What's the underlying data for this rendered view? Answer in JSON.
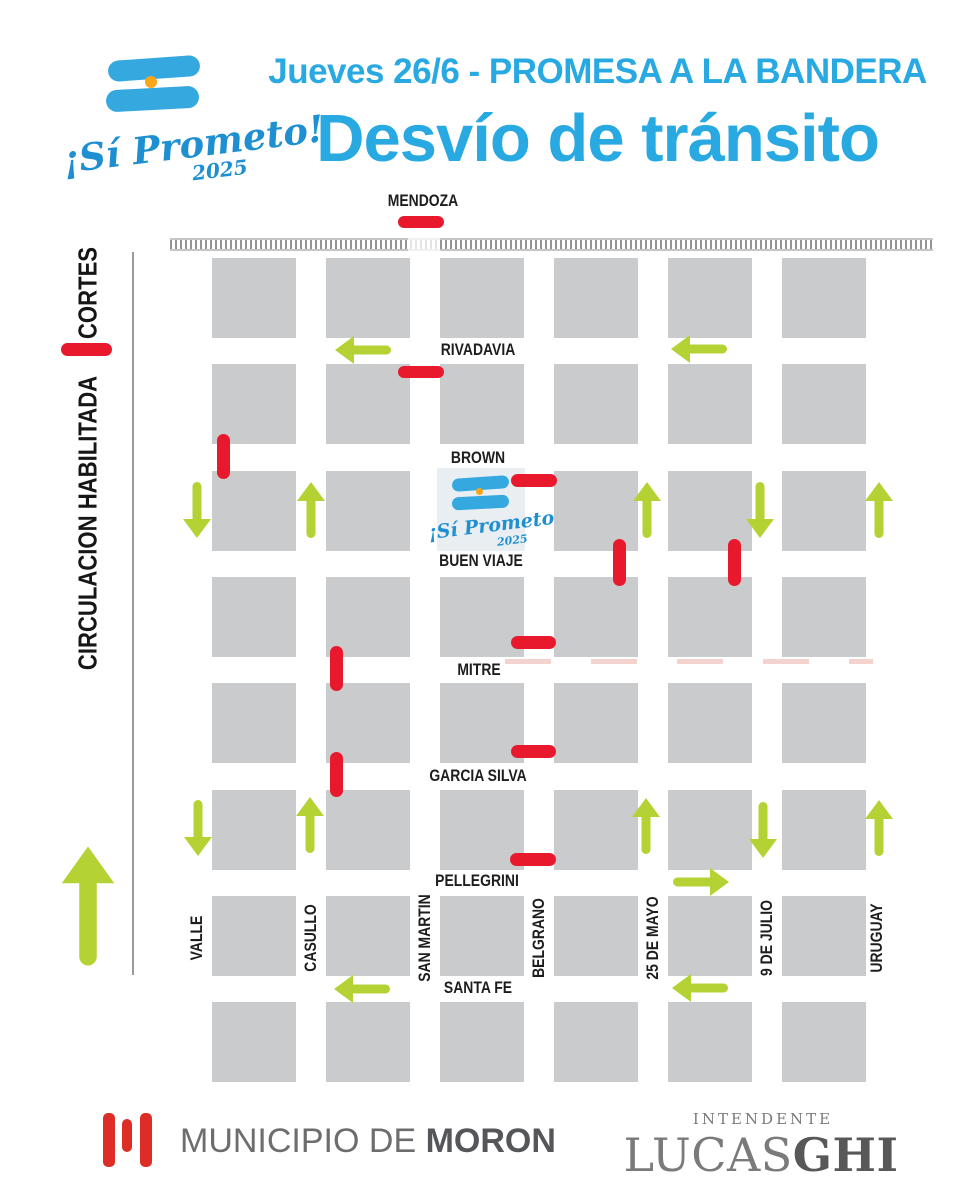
{
  "header": {
    "logo": {
      "script": "¡Sí Prometo!",
      "year": "2025"
    },
    "date_line": "Jueves 26/6 - PROMESA A LA BANDERA",
    "title": "Desvío de tránsito"
  },
  "legend": {
    "cortes_label": "CORTES",
    "circulacion_label": "CIRCULACION HABILITADA"
  },
  "map": {
    "grid": {
      "col_lefts": [
        212,
        326,
        440,
        554,
        668,
        782
      ],
      "row_tops": [
        258,
        364,
        471,
        577,
        683,
        790,
        896,
        1002
      ],
      "block_w": 84,
      "block_h": 80,
      "logo_block": {
        "col": 2,
        "row": 2
      }
    },
    "railway": {
      "x": 170,
      "y": 238,
      "w": 763,
      "h": 13,
      "gap_x": 408,
      "gap_w": 32
    },
    "edge_line": {
      "x": 132,
      "y": 252,
      "h": 723
    },
    "mitre_dashes": {
      "x": 505,
      "y": 659,
      "w": 368,
      "h": 5
    },
    "streets_horizontal": [
      "MENDOZA",
      "RIVADAVIA",
      "BROWN",
      "BUEN VIAJE",
      "MITRE",
      "GARCIA SILVA",
      "PELLEGRINI",
      "SANTA FE"
    ],
    "streets_vertical": [
      "VALLE",
      "CASULLO",
      "SAN MARTIN",
      "BELGRANO",
      "25 DE MAYO",
      "9 DE JULIO",
      "URUGUAY"
    ],
    "labels_h": [
      {
        "text": "MENDOZA",
        "x": 423,
        "y": 201
      },
      {
        "text": "RIVADAVIA",
        "x": 478,
        "y": 350
      },
      {
        "text": "BROWN",
        "x": 478,
        "y": 458
      },
      {
        "text": "BUEN VIAJE",
        "x": 481,
        "y": 561
      },
      {
        "text": "MITRE",
        "x": 479,
        "y": 670
      },
      {
        "text": "GARCIA SILVA",
        "x": 478,
        "y": 776
      },
      {
        "text": "PELLEGRINI",
        "x": 477,
        "y": 881
      },
      {
        "text": "SANTA FE",
        "x": 478,
        "y": 988
      }
    ],
    "labels_v": [
      {
        "text": "VALLE",
        "x": 197,
        "y": 938
      },
      {
        "text": "CASULLO",
        "x": 311,
        "y": 938
      },
      {
        "text": "SAN MARTIN",
        "x": 425,
        "y": 938
      },
      {
        "text": "BELGRANO",
        "x": 539,
        "y": 938
      },
      {
        "text": "25 DE MAYO",
        "x": 653,
        "y": 938
      },
      {
        "text": "9 DE JULIO",
        "x": 767,
        "y": 938
      },
      {
        "text": "URUGUAY",
        "x": 877,
        "y": 938
      }
    ],
    "closures": [
      {
        "street": "SAN MARTIN",
        "at": "MENDOZA",
        "x": 398,
        "y": 216,
        "w": 46,
        "h": 12
      },
      {
        "street": "SAN MARTIN",
        "at": "RIVADAVIA",
        "x": 398,
        "y": 366,
        "w": 46,
        "h": 12
      },
      {
        "street": "BROWN",
        "at": "VALLE",
        "x": 217,
        "y": 434,
        "w": 13,
        "h": 45
      },
      {
        "street": "BELGRANO",
        "at": "BROWN",
        "x": 511,
        "y": 474,
        "w": 46,
        "h": 13
      },
      {
        "street": "BUEN VIAJE",
        "at": "25 DE MAYO",
        "x": 613,
        "y": 539,
        "w": 13,
        "h": 47
      },
      {
        "street": "BUEN VIAJE",
        "at": "9 DE JULIO",
        "x": 728,
        "y": 539,
        "w": 13,
        "h": 47
      },
      {
        "street": "BELGRANO",
        "at": "MITRE",
        "x": 511,
        "y": 636,
        "w": 45,
        "h": 13
      },
      {
        "street": "MITRE",
        "at": "CASULLO",
        "x": 330,
        "y": 646,
        "w": 13,
        "h": 45
      },
      {
        "street": "BELGRANO",
        "at": "GARCIA SILVA",
        "x": 511,
        "y": 745,
        "w": 45,
        "h": 13
      },
      {
        "street": "GARCIA SILVA",
        "at": "CASULLO",
        "x": 330,
        "y": 752,
        "w": 13,
        "h": 45
      },
      {
        "street": "BELGRANO",
        "at": "PELLEGRINI",
        "x": 510,
        "y": 853,
        "w": 46,
        "h": 13
      }
    ],
    "arrows": [
      {
        "street": "RIVADAVIA",
        "dir": "left",
        "x": 363,
        "y": 350
      },
      {
        "street": "RIVADAVIA",
        "dir": "left",
        "x": 699,
        "y": 349
      },
      {
        "street": "VALLE",
        "dir": "down",
        "x": 197,
        "y": 510
      },
      {
        "street": "CASULLO",
        "dir": "up",
        "x": 311,
        "y": 510
      },
      {
        "street": "25 DE MAYO",
        "dir": "up",
        "x": 647,
        "y": 510
      },
      {
        "street": "9 DE JULIO",
        "dir": "down",
        "x": 760,
        "y": 510
      },
      {
        "street": "URUGUAY",
        "dir": "up",
        "x": 879,
        "y": 510
      },
      {
        "street": "VALLE",
        "dir": "down",
        "x": 198,
        "y": 828
      },
      {
        "street": "CASULLO",
        "dir": "up",
        "x": 310,
        "y": 825
      },
      {
        "street": "25 DE MAYO",
        "dir": "up",
        "x": 646,
        "y": 826
      },
      {
        "street": "9 DE JULIO",
        "dir": "down",
        "x": 763,
        "y": 830
      },
      {
        "street": "URUGUAY",
        "dir": "up",
        "x": 879,
        "y": 828
      },
      {
        "street": "PELLEGRINI",
        "dir": "right",
        "x": 701,
        "y": 882
      },
      {
        "street": "SANTA FE",
        "dir": "left",
        "x": 362,
        "y": 989
      },
      {
        "street": "SANTA FE",
        "dir": "left",
        "x": 700,
        "y": 988
      }
    ]
  },
  "footer": {
    "municipio_prefix": "MUNICIPIO DE ",
    "municipio_bold": "MORON",
    "intendente_label": "INTENDENTE",
    "name_light": "LUCAS",
    "name_bold": "GHI"
  },
  "colors": {
    "cyan": "#29a9e1",
    "script_blue": "#1e8fd0",
    "flag_blue": "#35a8e0",
    "sun": "#f9a61a",
    "red": "#e8192d",
    "green": "#b4d233",
    "block_gray": "#c9cbcd",
    "logo_block_bg": "#e9eef3",
    "label_black": "#1d1d1f",
    "moron_red": "#de2d26"
  }
}
